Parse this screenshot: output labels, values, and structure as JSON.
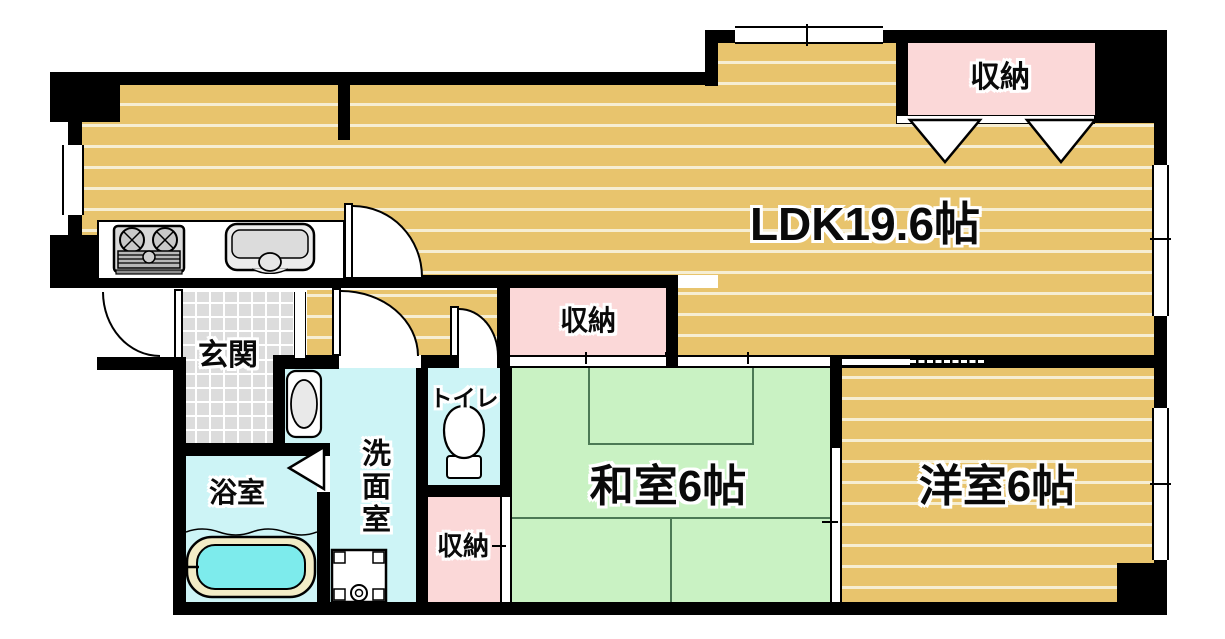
{
  "plan": {
    "ldk": "LDK19.6帖",
    "washitsu": "和室6帖",
    "yoshitsu": "洋室6帖",
    "genkan": "玄関",
    "bath": "浴室",
    "washroom": "洗面室",
    "toilet": "トイレ",
    "storage_top": "収納",
    "storage_mid": "収納",
    "storage_bottom": "収納"
  },
  "colors": {
    "wall": "#000000",
    "wood_floor": "#e8c46d",
    "wood_stripe": "#f6eed3",
    "tatami_green": "#c9f2c3",
    "storage_pink": "#fbd8d8",
    "wet_area_cyan": "#cdf4f6",
    "tile_gray": "#dcdcdc",
    "bath_water": "#7debec"
  }
}
